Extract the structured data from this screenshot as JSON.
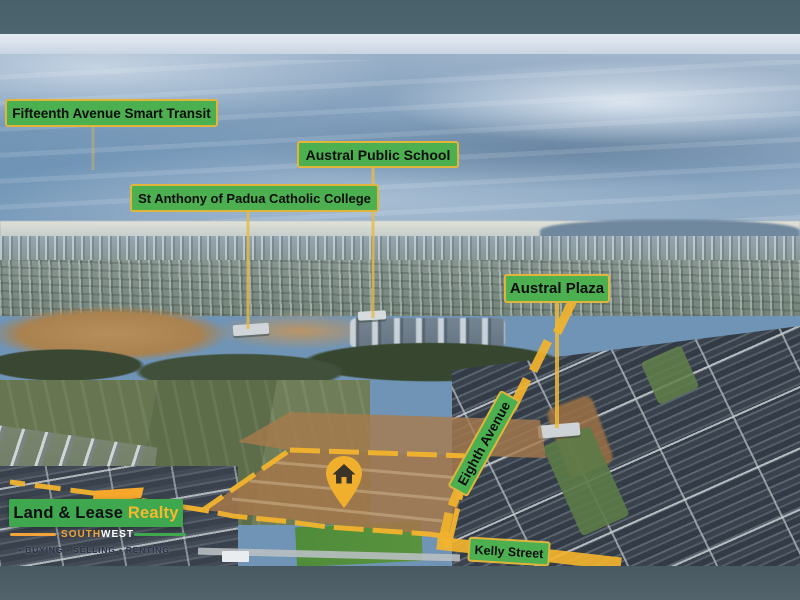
{
  "labels": {
    "transit": "Fifteenth Avenue Smart Transit",
    "school": "Austral Public School",
    "college": "St Anthony of Padua Catholic College",
    "plaza": "Austral Plaza",
    "eighth_avenue": "Eighth Avenue",
    "kelly_street": "Kelly Street"
  },
  "logo": {
    "brand_black": "Land & Lease ",
    "brand_accent": "Realty",
    "region_left": "SOUTH",
    "region_right": "WEST",
    "tagline": "• BUYING • SELLING • RENTING"
  },
  "icons": {
    "pin": "house-map-pin-icon"
  },
  "colors": {
    "label_green": "#4caf50",
    "label_border_yellow": "#e0b53c",
    "highlight_yellow": "#f2b32d",
    "logo_green": "#3fa84e",
    "logo_orange": "#f5a82c",
    "sky_dark_band": "#4a636c",
    "bottom_bar": "#4e5f66"
  }
}
